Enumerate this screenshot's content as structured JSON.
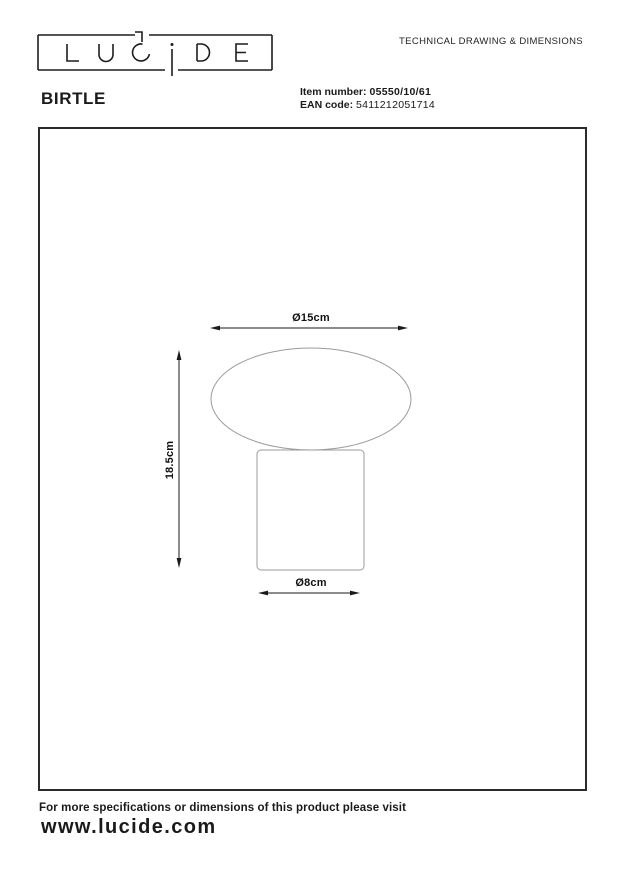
{
  "header": {
    "logo_text": "LUCIDE",
    "doc_title": "TECHNICAL DRAWING & DIMENSIONS",
    "product_name": "BIRTLE",
    "item_number_label": "Item number:",
    "item_number_value": "05550/10/61",
    "ean_label": "EAN code:",
    "ean_value": "5411212051714"
  },
  "drawing": {
    "dim_top_width": "Ø15cm",
    "dim_height": "18.5cm",
    "dim_base_width": "Ø8cm"
  },
  "footer": {
    "note": "For more specifications or dimensions of this product please visit",
    "website": "www.lucide.com"
  },
  "colors": {
    "ink": "#1a1a1a",
    "box_border": "#2b2b2b",
    "shape_stroke": "#9b9b9b",
    "dimension_line": "#1a1a1a"
  }
}
